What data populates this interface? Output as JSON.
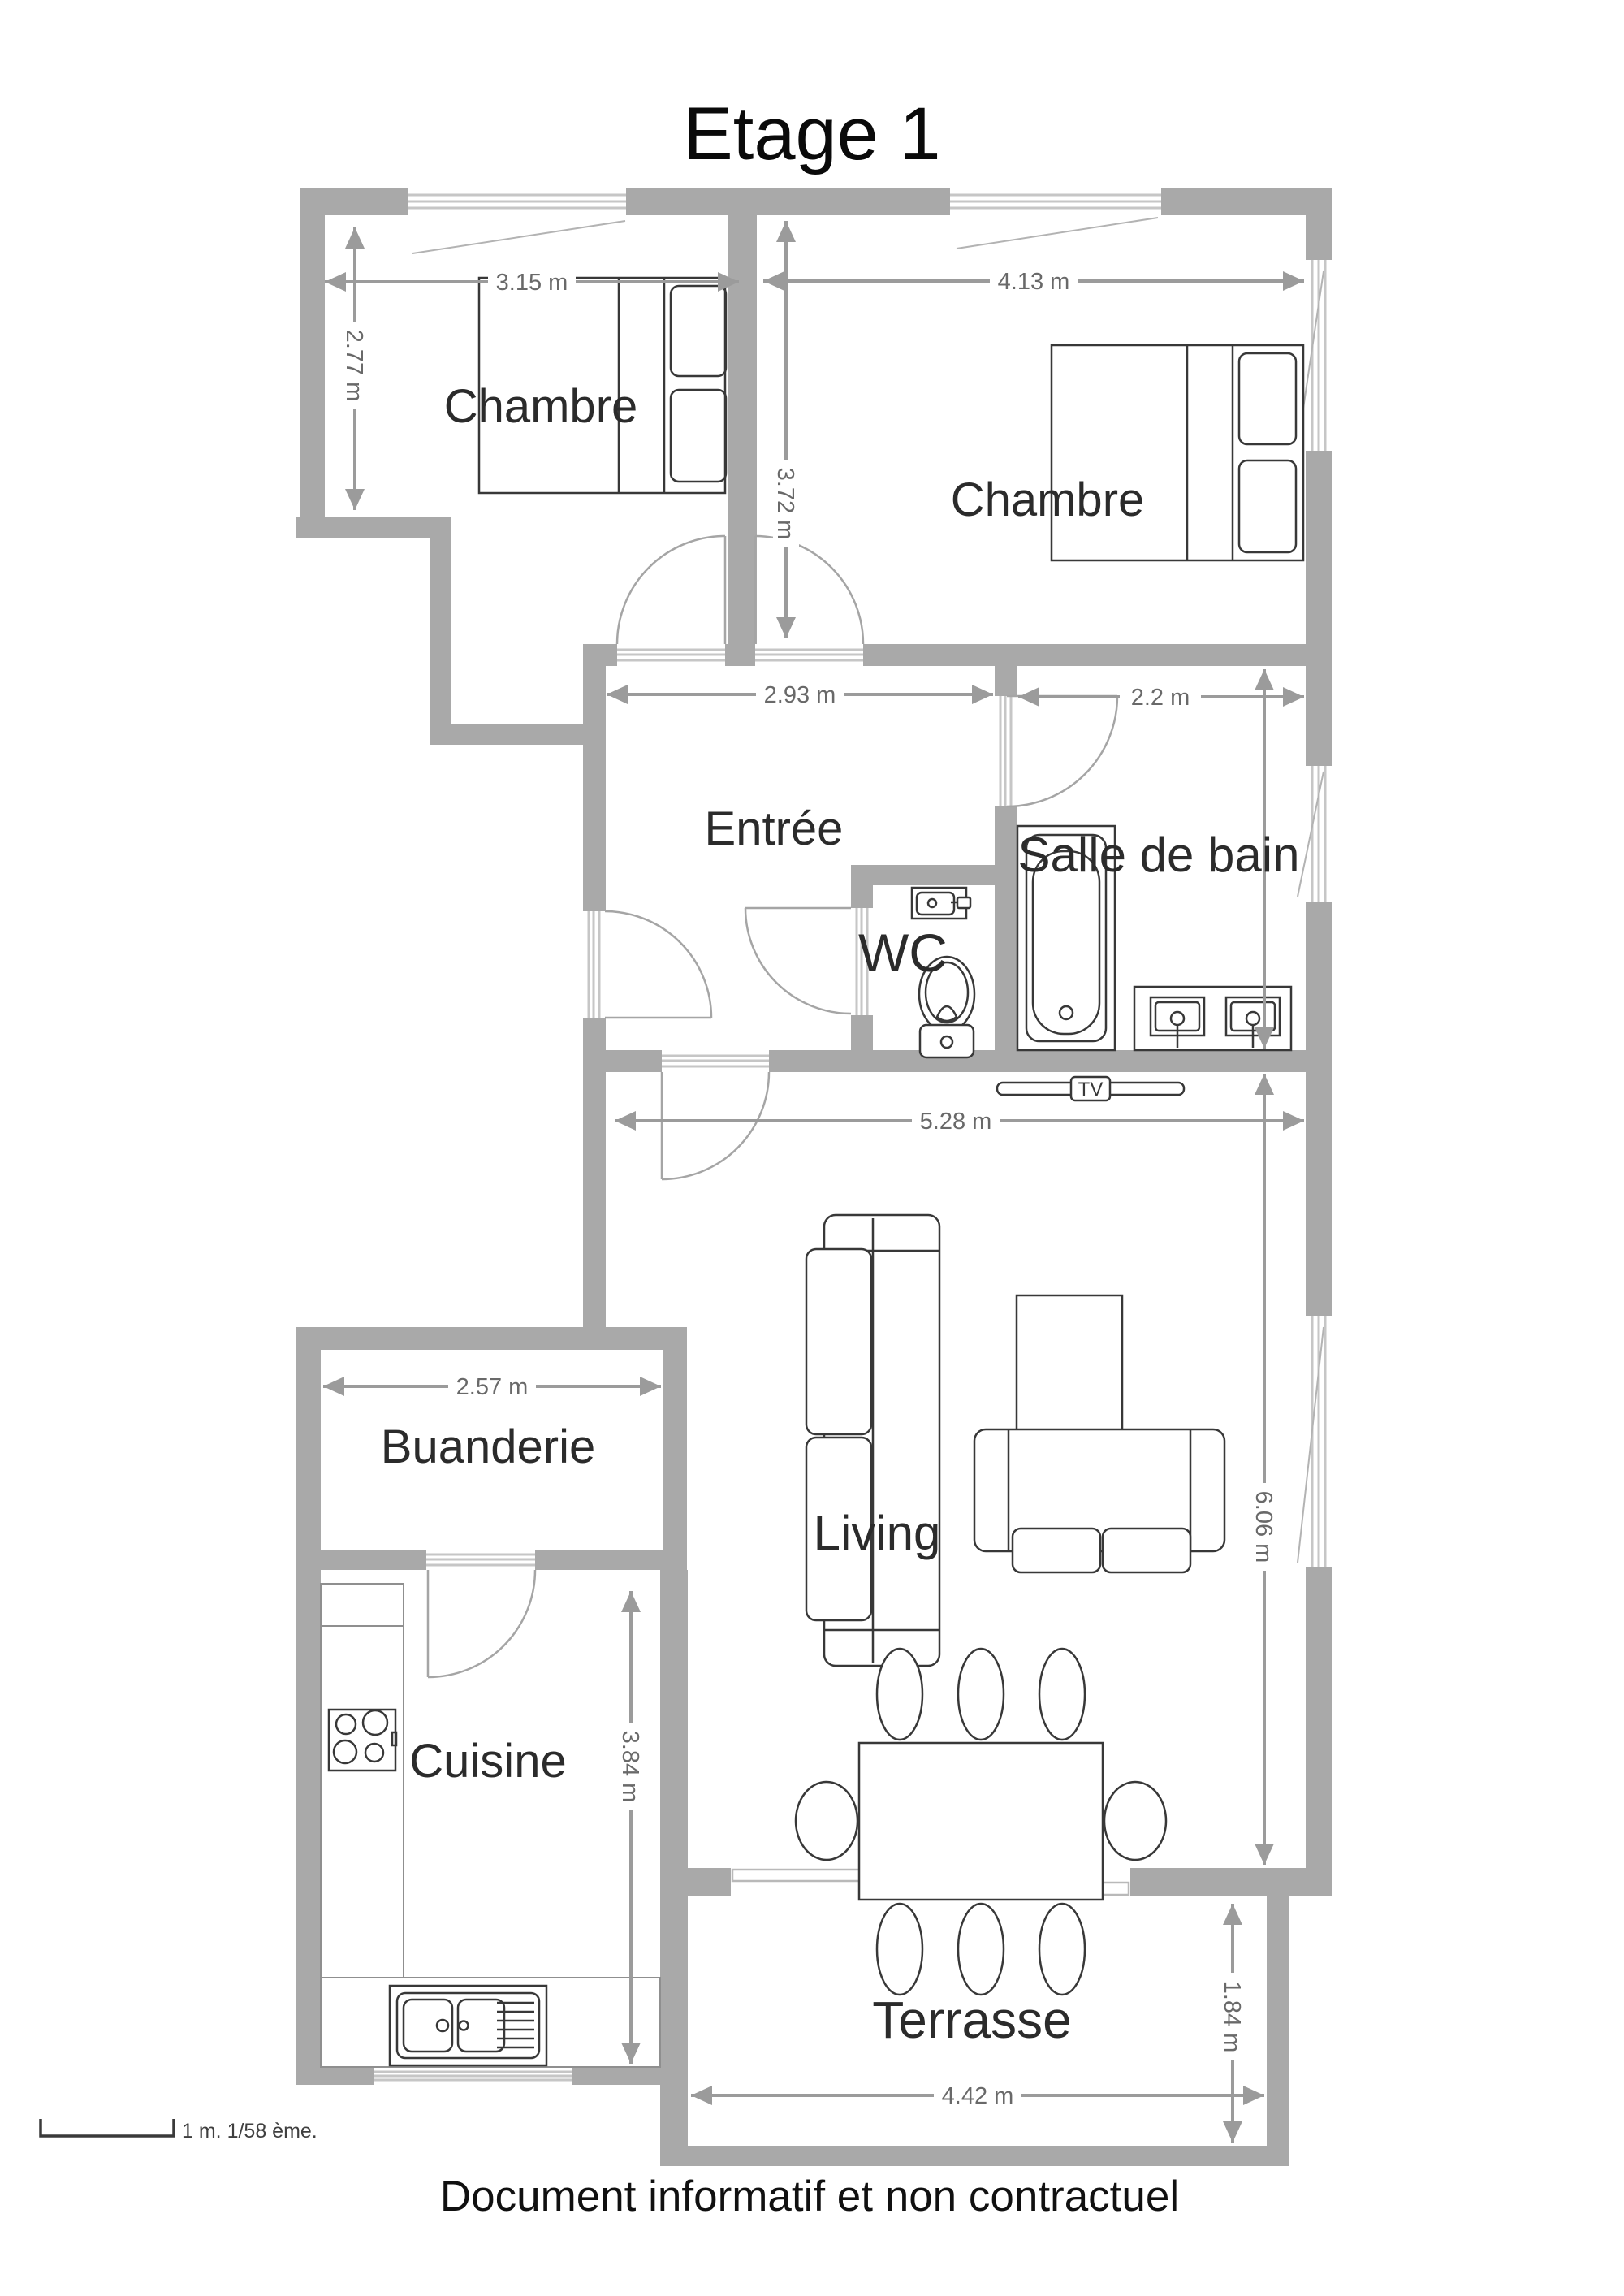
{
  "title": "Etage 1",
  "footer": "Document informatif et non contractuel",
  "scale_note": "1 m. 1/58 ème.",
  "tv": {
    "label": "TV"
  },
  "colors": {
    "wall": "#a9a9a9",
    "dimension_lines": "#9b9b9b",
    "dimension_text": "#696969",
    "room_label_text": "#2b2b2b",
    "furniture_outline": "#383838",
    "background": "#ffffff"
  },
  "rooms": {
    "chambre1": {
      "label": "Chambre"
    },
    "chambre2": {
      "label": "Chambre"
    },
    "entree": {
      "label": "Entrée"
    },
    "salle_de_bain": {
      "label": "Salle de bain"
    },
    "wc": {
      "label": "WC"
    },
    "buanderie": {
      "label": "Buanderie"
    },
    "cuisine": {
      "label": "Cuisine"
    },
    "living": {
      "label": "Living"
    },
    "terrasse": {
      "label": "Terrasse"
    }
  },
  "dimensions": {
    "chambre1_width": {
      "label": "3.15 m",
      "meters": 3.15
    },
    "chambre2_width": {
      "label": "4.13 m",
      "meters": 4.13
    },
    "chambre1_height": {
      "label": "2.77 m",
      "meters": 2.77
    },
    "chambre2_height": {
      "label": "3.72 m",
      "meters": 3.72
    },
    "entree_width": {
      "label": "2.93 m",
      "meters": 2.93
    },
    "bain_width": {
      "label": "2.2 m",
      "meters": 2.2
    },
    "living_width": {
      "label": "5.28 m",
      "meters": 5.28
    },
    "living_height": {
      "label": "6.06 m",
      "meters": 6.06
    },
    "buanderie_width": {
      "label": "2.57 m",
      "meters": 2.57
    },
    "cuisine_height": {
      "label": "3.84 m",
      "meters": 3.84
    },
    "terrasse_width": {
      "label": "4.42 m",
      "meters": 4.42
    },
    "terrasse_height": {
      "label": "1.84 m",
      "meters": 1.84
    }
  }
}
